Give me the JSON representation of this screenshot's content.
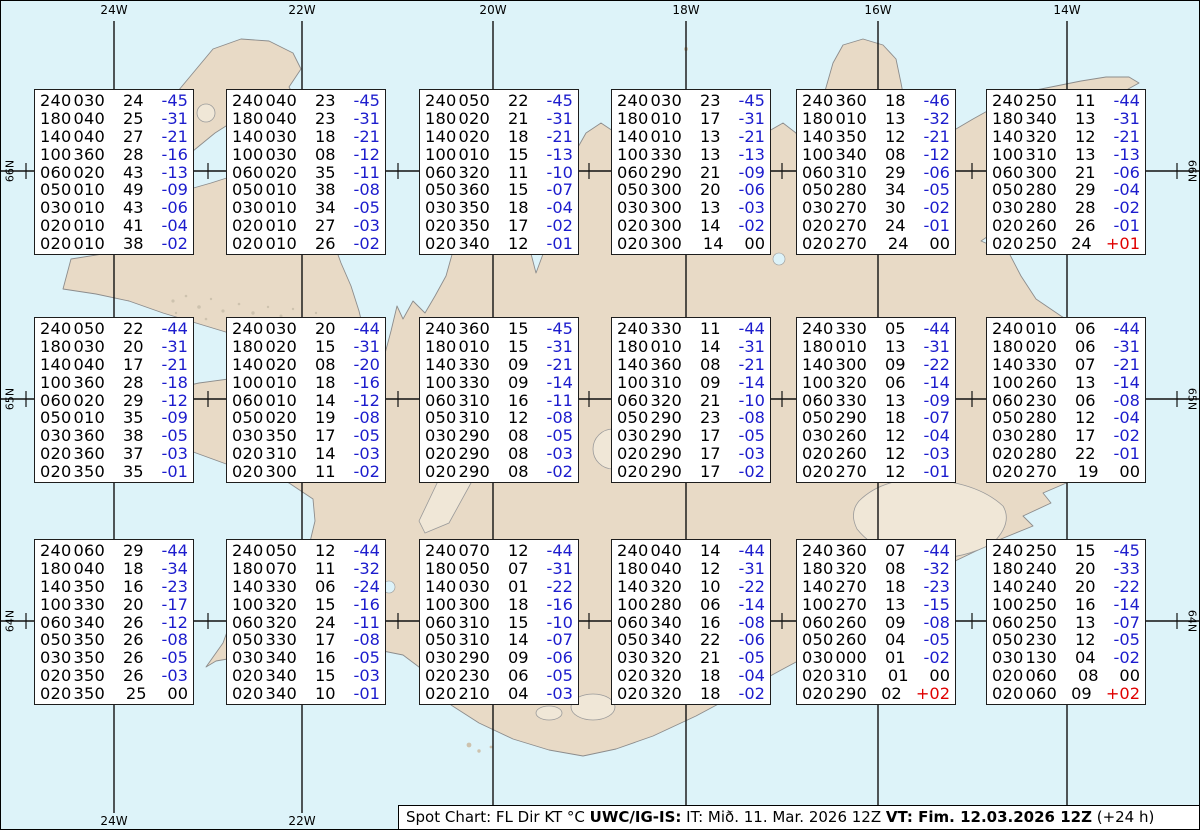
{
  "title": "Spot Chart FL Dir KT °C - Iceland",
  "colors": {
    "ocean": "#ddf3f9",
    "land": "#e8dac6",
    "coastline": "#8c8c8c",
    "grid": "#111111",
    "temp_negative": "#1c1ccd",
    "temp_positive": "#e00000",
    "text": "#000000",
    "box_background": "#ffffff"
  },
  "labels": {
    "top": [
      "24W",
      "22W",
      "20W",
      "18W",
      "16W",
      "14W"
    ],
    "bottom": [
      "24W",
      "22W"
    ],
    "left": [
      "66N",
      "65N",
      "64N"
    ],
    "right": [
      "66N",
      "65N",
      "64N"
    ]
  },
  "footer": {
    "prefix": "Spot Chart: FL Dir KT °C ",
    "product_bold": "UWC/IG-IS:",
    "issue_time": " IT: Mið. 11. Mar. 2026 12Z ",
    "valid_bold": "VT: Fim. 12.03.2026 12Z",
    "suffix": " (+24 h)"
  },
  "boxes": [
    {
      "lines": [
        [
          "240030",
          "24",
          "-45"
        ],
        [
          "180040",
          "25",
          "-31"
        ],
        [
          "140040",
          "27",
          "-21"
        ],
        [
          "100360",
          "28",
          "-16"
        ],
        [
          "060020",
          "43",
          "-13"
        ],
        [
          "050010",
          "49",
          "-09"
        ],
        [
          "030010",
          "43",
          "-06"
        ],
        [
          "020010",
          "41",
          "-04"
        ],
        [
          "020010",
          "38",
          "-02"
        ]
      ]
    },
    {
      "lines": [
        [
          "240040",
          "23",
          "-45"
        ],
        [
          "180040",
          "23",
          "-31"
        ],
        [
          "140030",
          "18",
          "-21"
        ],
        [
          "100030",
          "08",
          "-12"
        ],
        [
          "060020",
          "35",
          "-11"
        ],
        [
          "050010",
          "38",
          "-08"
        ],
        [
          "030010",
          "34",
          "-05"
        ],
        [
          "020010",
          "27",
          "-03"
        ],
        [
          "020010",
          "26",
          "-02"
        ]
      ]
    },
    {
      "lines": [
        [
          "240050",
          "22",
          "-45"
        ],
        [
          "180020",
          "21",
          "-31"
        ],
        [
          "140020",
          "18",
          "-21"
        ],
        [
          "100010",
          "15",
          "-13"
        ],
        [
          "060320",
          "11",
          "-10"
        ],
        [
          "050360",
          "15",
          "-07"
        ],
        [
          "030350",
          "18",
          "-04"
        ],
        [
          "020350",
          "17",
          "-02"
        ],
        [
          "020340",
          "12",
          "-01"
        ]
      ]
    },
    {
      "lines": [
        [
          "240030",
          "23",
          "-45"
        ],
        [
          "180010",
          "17",
          "-31"
        ],
        [
          "140010",
          "13",
          "-21"
        ],
        [
          "100330",
          "13",
          "-13"
        ],
        [
          "060290",
          "21",
          "-09"
        ],
        [
          "050300",
          "20",
          "-06"
        ],
        [
          "030300",
          "13",
          "-03"
        ],
        [
          "020300",
          "14",
          "-02"
        ],
        [
          "020300",
          "14",
          "00"
        ]
      ]
    },
    {
      "lines": [
        [
          "240360",
          "18",
          "-46"
        ],
        [
          "180010",
          "13",
          "-32"
        ],
        [
          "140350",
          "12",
          "-21"
        ],
        [
          "100340",
          "08",
          "-12"
        ],
        [
          "060310",
          "29",
          "-06"
        ],
        [
          "050280",
          "34",
          "-05"
        ],
        [
          "030270",
          "30",
          "-02"
        ],
        [
          "020270",
          "24",
          "-01"
        ],
        [
          "020270",
          "24",
          "00"
        ]
      ]
    },
    {
      "lines": [
        [
          "240250",
          "11",
          "-44"
        ],
        [
          "180340",
          "13",
          "-31"
        ],
        [
          "140320",
          "12",
          "-21"
        ],
        [
          "100310",
          "13",
          "-13"
        ],
        [
          "060300",
          "21",
          "-06"
        ],
        [
          "050280",
          "29",
          "-04"
        ],
        [
          "030280",
          "28",
          "-02"
        ],
        [
          "020260",
          "26",
          "-01"
        ],
        [
          "020250",
          "24",
          "+01"
        ]
      ]
    },
    {
      "lines": [
        [
          "240050",
          "22",
          "-44"
        ],
        [
          "180030",
          "20",
          "-31"
        ],
        [
          "140040",
          "17",
          "-21"
        ],
        [
          "100360",
          "28",
          "-18"
        ],
        [
          "060020",
          "29",
          "-12"
        ],
        [
          "050010",
          "35",
          "-09"
        ],
        [
          "030360",
          "38",
          "-05"
        ],
        [
          "020360",
          "37",
          "-03"
        ],
        [
          "020350",
          "35",
          "-01"
        ]
      ]
    },
    {
      "lines": [
        [
          "240030",
          "20",
          "-44"
        ],
        [
          "180020",
          "15",
          "-31"
        ],
        [
          "140020",
          "08",
          "-20"
        ],
        [
          "100010",
          "18",
          "-16"
        ],
        [
          "060010",
          "14",
          "-12"
        ],
        [
          "050020",
          "19",
          "-08"
        ],
        [
          "030350",
          "17",
          "-05"
        ],
        [
          "020310",
          "14",
          "-03"
        ],
        [
          "020300",
          "11",
          "-02"
        ]
      ]
    },
    {
      "lines": [
        [
          "240360",
          "15",
          "-45"
        ],
        [
          "180010",
          "15",
          "-31"
        ],
        [
          "140330",
          "09",
          "-21"
        ],
        [
          "100330",
          "09",
          "-14"
        ],
        [
          "060310",
          "16",
          "-11"
        ],
        [
          "050310",
          "12",
          "-08"
        ],
        [
          "030290",
          "08",
          "-05"
        ],
        [
          "020290",
          "08",
          "-03"
        ],
        [
          "020290",
          "08",
          "-02"
        ]
      ]
    },
    {
      "lines": [
        [
          "240330",
          "11",
          "-44"
        ],
        [
          "180010",
          "14",
          "-31"
        ],
        [
          "140360",
          "08",
          "-21"
        ],
        [
          "100310",
          "09",
          "-14"
        ],
        [
          "060320",
          "21",
          "-10"
        ],
        [
          "050290",
          "23",
          "-08"
        ],
        [
          "030290",
          "17",
          "-05"
        ],
        [
          "020290",
          "17",
          "-03"
        ],
        [
          "020290",
          "17",
          "-02"
        ]
      ]
    },
    {
      "lines": [
        [
          "240330",
          "05",
          "-44"
        ],
        [
          "180010",
          "13",
          "-31"
        ],
        [
          "140300",
          "09",
          "-22"
        ],
        [
          "100320",
          "06",
          "-14"
        ],
        [
          "060330",
          "13",
          "-09"
        ],
        [
          "050290",
          "18",
          "-07"
        ],
        [
          "030260",
          "12",
          "-04"
        ],
        [
          "020260",
          "12",
          "-03"
        ],
        [
          "020270",
          "12",
          "-01"
        ]
      ]
    },
    {
      "lines": [
        [
          "240010",
          "06",
          "-44"
        ],
        [
          "180020",
          "06",
          "-31"
        ],
        [
          "140330",
          "07",
          "-21"
        ],
        [
          "100260",
          "13",
          "-14"
        ],
        [
          "060230",
          "06",
          "-08"
        ],
        [
          "050280",
          "12",
          "-04"
        ],
        [
          "030280",
          "17",
          "-02"
        ],
        [
          "020280",
          "22",
          "-01"
        ],
        [
          "020270",
          "19",
          "00"
        ]
      ]
    },
    {
      "lines": [
        [
          "240060",
          "29",
          "-44"
        ],
        [
          "180040",
          "18",
          "-34"
        ],
        [
          "140350",
          "16",
          "-23"
        ],
        [
          "100330",
          "20",
          "-17"
        ],
        [
          "060340",
          "26",
          "-12"
        ],
        [
          "050350",
          "26",
          "-08"
        ],
        [
          "030350",
          "26",
          "-05"
        ],
        [
          "020350",
          "26",
          "-03"
        ],
        [
          "020350",
          "25",
          "00"
        ]
      ]
    },
    {
      "lines": [
        [
          "240050",
          "12",
          "-44"
        ],
        [
          "180070",
          "11",
          "-32"
        ],
        [
          "140330",
          "06",
          "-24"
        ],
        [
          "100320",
          "15",
          "-16"
        ],
        [
          "060320",
          "24",
          "-11"
        ],
        [
          "050330",
          "17",
          "-08"
        ],
        [
          "030340",
          "16",
          "-05"
        ],
        [
          "020340",
          "15",
          "-03"
        ],
        [
          "020340",
          "10",
          "-01"
        ]
      ]
    },
    {
      "lines": [
        [
          "240070",
          "12",
          "-44"
        ],
        [
          "180050",
          "07",
          "-31"
        ],
        [
          "140030",
          "01",
          "-22"
        ],
        [
          "100300",
          "18",
          "-16"
        ],
        [
          "060310",
          "15",
          "-10"
        ],
        [
          "050310",
          "14",
          "-07"
        ],
        [
          "030290",
          "09",
          "-06"
        ],
        [
          "020230",
          "06",
          "-05"
        ],
        [
          "020210",
          "04",
          "-03"
        ]
      ]
    },
    {
      "lines": [
        [
          "240040",
          "14",
          "-44"
        ],
        [
          "180040",
          "12",
          "-31"
        ],
        [
          "140320",
          "10",
          "-22"
        ],
        [
          "100280",
          "06",
          "-14"
        ],
        [
          "060340",
          "16",
          "-08"
        ],
        [
          "050340",
          "22",
          "-06"
        ],
        [
          "030320",
          "21",
          "-05"
        ],
        [
          "020320",
          "18",
          "-04"
        ],
        [
          "020320",
          "18",
          "-02"
        ]
      ]
    },
    {
      "lines": [
        [
          "240360",
          "07",
          "-44"
        ],
        [
          "180320",
          "08",
          "-32"
        ],
        [
          "140270",
          "18",
          "-23"
        ],
        [
          "100270",
          "13",
          "-15"
        ],
        [
          "060260",
          "09",
          "-08"
        ],
        [
          "050260",
          "04",
          "-05"
        ],
        [
          "030000",
          "01",
          "-02"
        ],
        [
          "020310",
          "01",
          "00"
        ],
        [
          "020290",
          "02",
          "+02"
        ]
      ]
    },
    {
      "lines": [
        [
          "240250",
          "15",
          "-45"
        ],
        [
          "180240",
          "20",
          "-33"
        ],
        [
          "140240",
          "20",
          "-22"
        ],
        [
          "100250",
          "16",
          "-14"
        ],
        [
          "060250",
          "13",
          "-07"
        ],
        [
          "050230",
          "12",
          "-05"
        ],
        [
          "030130",
          "04",
          "-02"
        ],
        [
          "020060",
          "08",
          "00"
        ],
        [
          "020060",
          "09",
          "+02"
        ]
      ]
    }
  ]
}
